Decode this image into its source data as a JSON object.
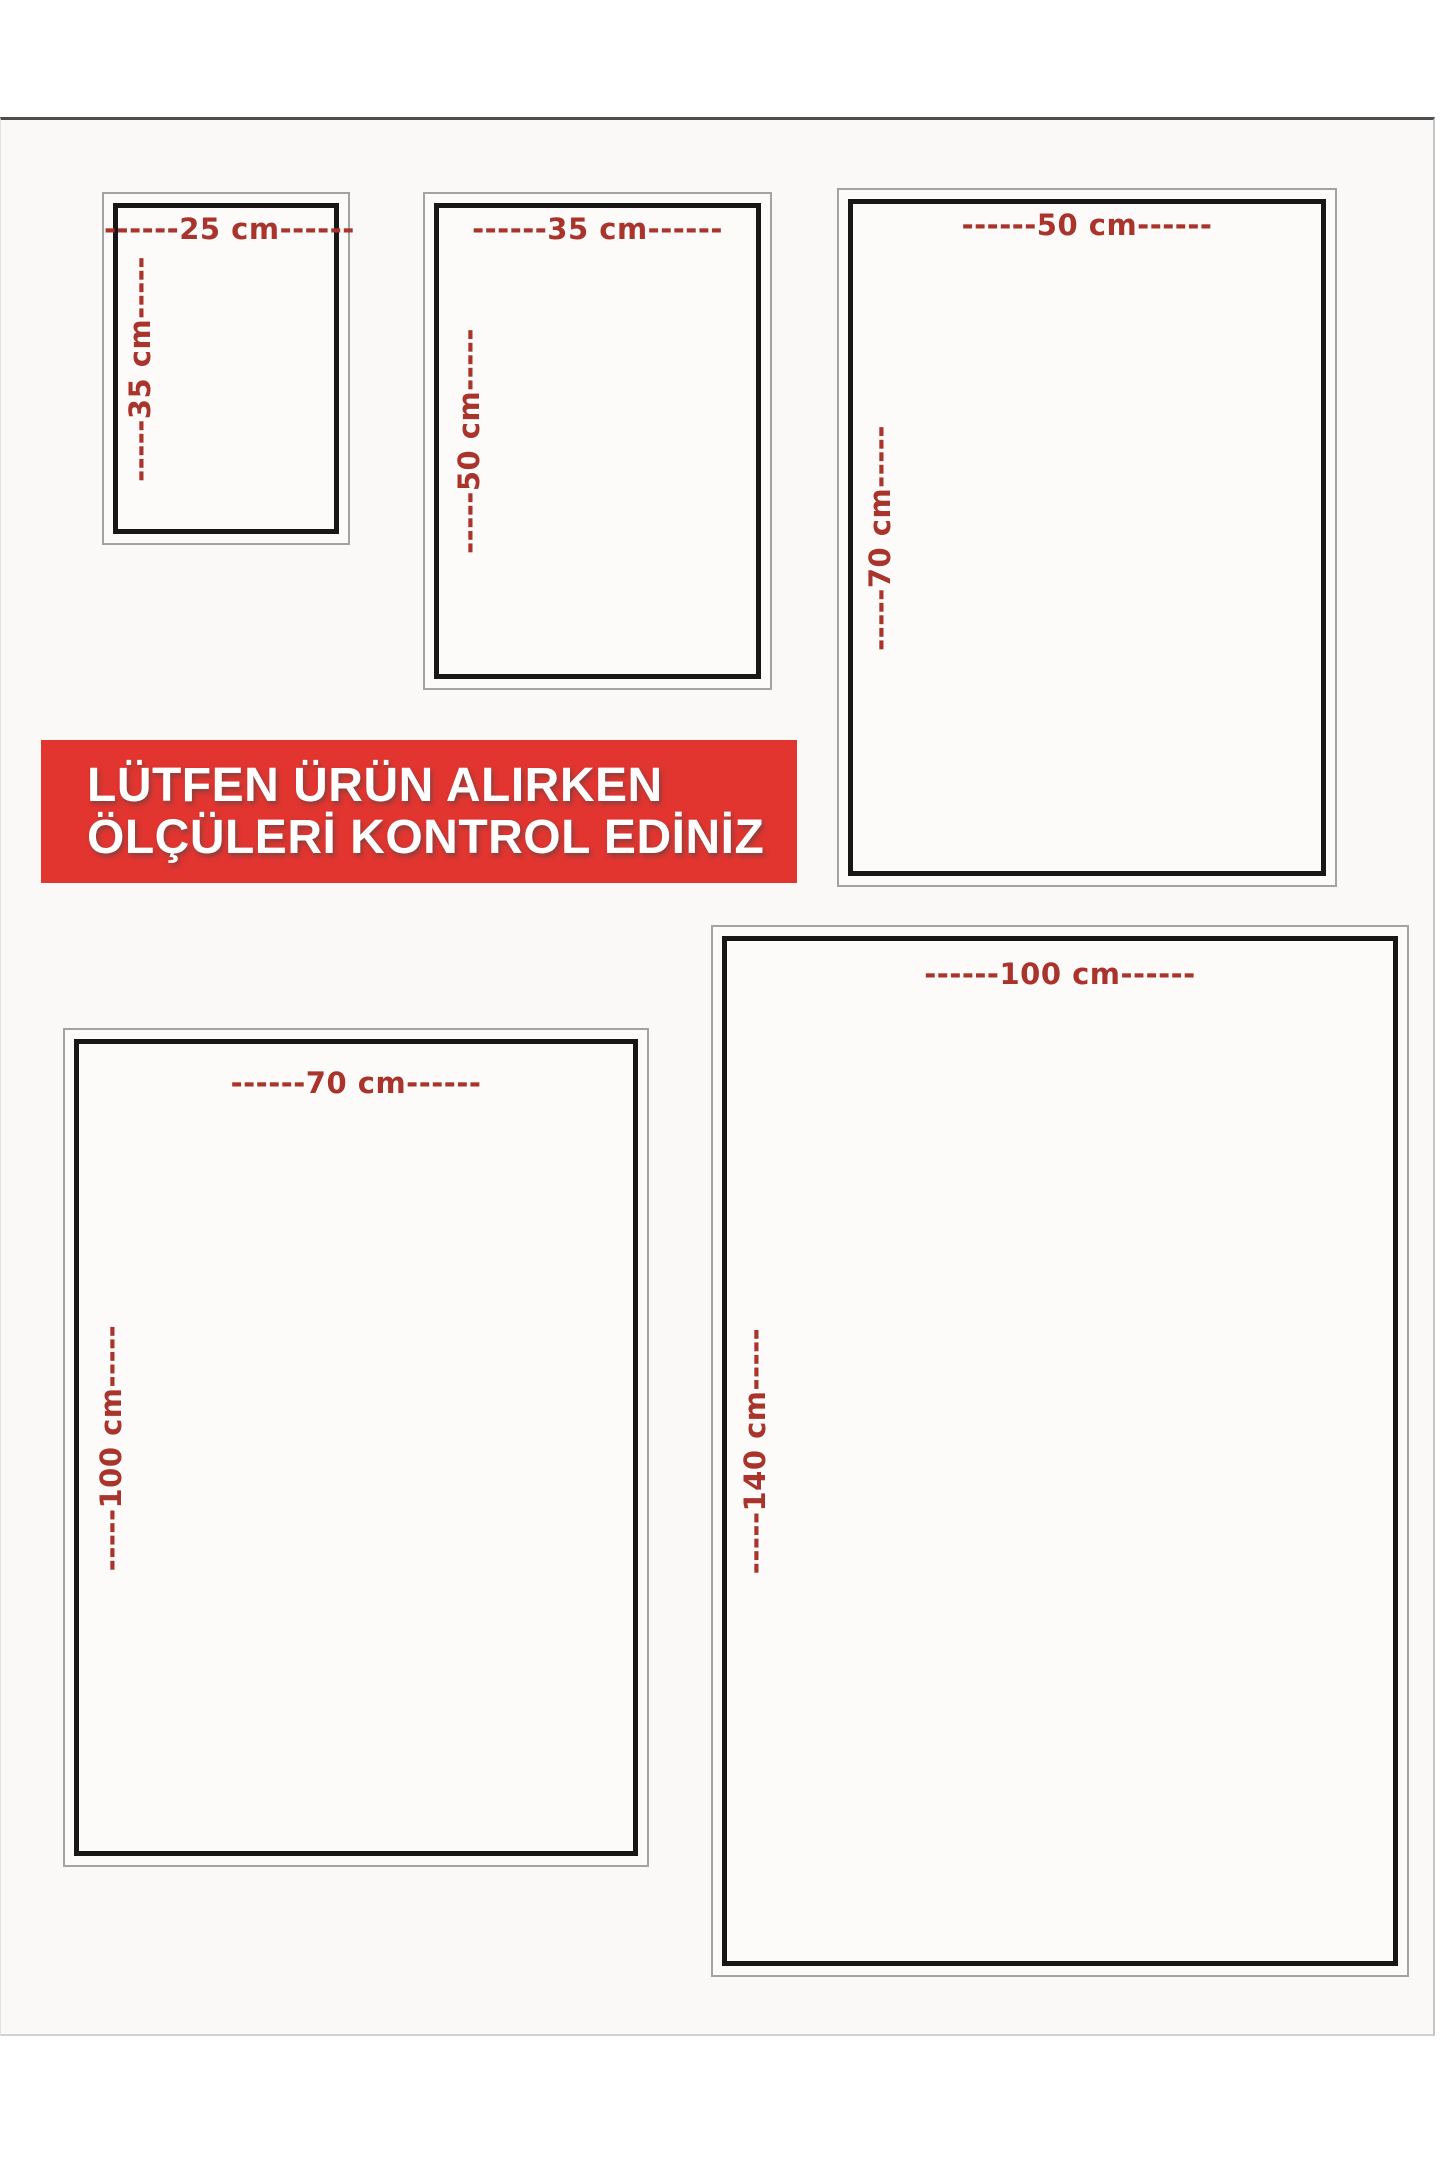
{
  "notice": {
    "line1": "LÜTFEN ÜRÜN ALIRKEN",
    "line2": "ÖLÇÜLERİ KONTROL EDİNİZ"
  },
  "sizes": [
    {
      "name": "25x35 cm",
      "width_label": "------25 cm------",
      "height_label": "-----35 cm-----"
    },
    {
      "name": "35x50 cm",
      "width_label": "------35 cm------",
      "height_label": "-----50 cm-----"
    },
    {
      "name": "50x70 cm",
      "width_label": "------50 cm------",
      "height_label": "-----70 cm-----"
    },
    {
      "name": "70x100 cm",
      "width_label": "------70 cm------",
      "height_label": "-----100 cm-----"
    },
    {
      "name": "100x140 cm",
      "width_label": "------100 cm------",
      "height_label": "-----140 cm-----"
    }
  ],
  "colors": {
    "banner_bg": "#e23530",
    "banner_text": "#ffffff",
    "dimension_text": "#a9342c",
    "inner_frame_border": "#171717",
    "outer_frame_border": "#a3a3a3",
    "page_bg": "#fbf9f7"
  }
}
